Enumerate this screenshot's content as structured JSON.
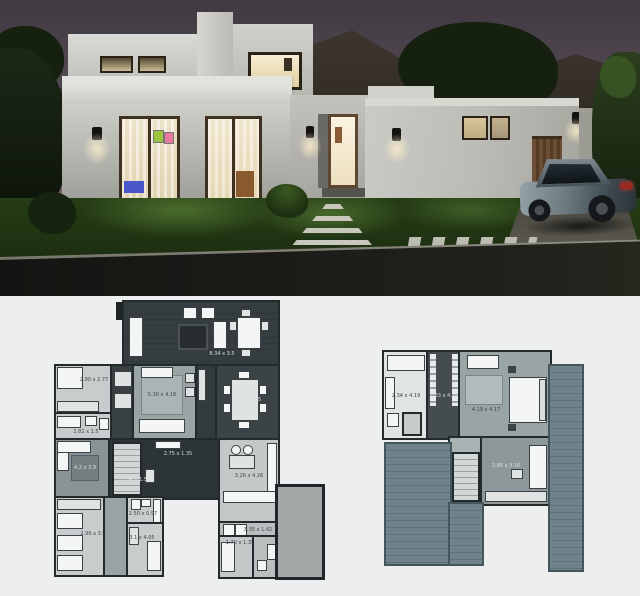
{
  "page": {
    "type": "architectural presentation",
    "background": "#ffffff"
  },
  "render": {
    "description": "dusk exterior render of a modern two storey white house with lit windows, lawn, stone path, driveway and parked sedan",
    "colors": {
      "sky_top": "#3f3942",
      "sky_horizon": "#887470",
      "wall_light": "#d9d9d5",
      "wall_shaded": "#a8a8a1",
      "window_glow": "#f2e3bc",
      "door_wood": "#5d4733",
      "lawn": "#2a4419",
      "street": "#151513",
      "garage_wood": "#6b4e33",
      "car_body": "#8b989e",
      "taillight": "#9c2a22"
    }
  },
  "plans": {
    "section_background": "#edefee",
    "ground_floor": {
      "name": "ground-floor-plan",
      "rooms": [
        {
          "id": "terrace",
          "label": "8.34 x 3.5"
        },
        {
          "id": "bedroom-1",
          "label": "2.90 x 2.77"
        },
        {
          "id": "bathroom-1",
          "label": "2.82 x 1.5"
        },
        {
          "id": "living-room",
          "label": "5.30 x 4.18"
        },
        {
          "id": "dining-room",
          "label": "5.17 x 4.15"
        },
        {
          "id": "family-room",
          "label": "4.2 x 3.9"
        },
        {
          "id": "hall",
          "label": "2.75 x 1.35"
        },
        {
          "id": "entry",
          "label": "1.54 x 1.56"
        },
        {
          "id": "kitchen",
          "label": "3.26 x 4.26"
        },
        {
          "id": "laundry",
          "label": "3.35 x 1.42"
        },
        {
          "id": "bedroom-2",
          "label": "2.96 x 3.9"
        },
        {
          "id": "bathroom-2",
          "label": "2.50 x 0.97"
        },
        {
          "id": "bedroom-3",
          "label": "3.1 x 4.05"
        },
        {
          "id": "service-room",
          "label": "1.70 x 1.35"
        }
      ]
    },
    "upper_floor": {
      "name": "upper-floor-plan",
      "rooms": [
        {
          "id": "bathroom",
          "label": "2.34 x 4.19"
        },
        {
          "id": "walk-in-closet",
          "label": "2.33 x 4.19"
        },
        {
          "id": "master-bedroom",
          "label": "4.19 x 4.17"
        },
        {
          "id": "sitting-room",
          "label": "3.86 x 3.16"
        }
      ]
    }
  }
}
